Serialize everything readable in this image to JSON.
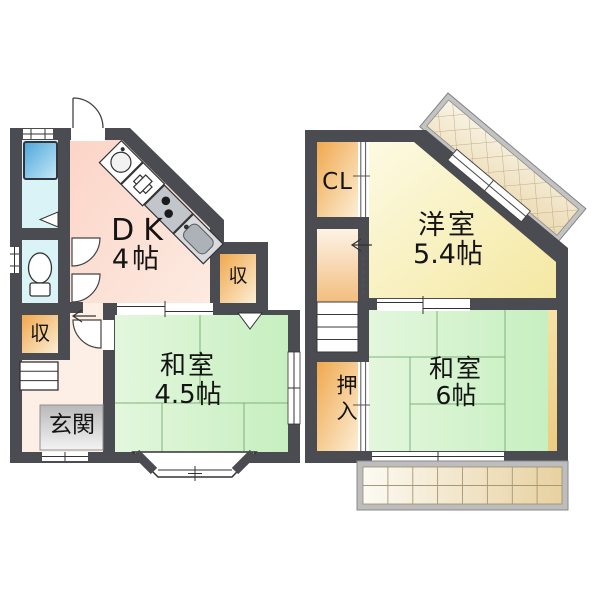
{
  "palette": {
    "wall": "#4b4b52",
    "tatami_green": "#cdefc6",
    "dk_pink": "#fbd8cb",
    "western_yellow": "#fbf4be",
    "closet_orange": "#f0a84e",
    "bath_cyan": "#d9f3f7",
    "tub_blue": "#56aadd",
    "balcony_beige": "#e9d4a5",
    "entry_gray": "#c4c4c4"
  },
  "floor1": {
    "dk": {
      "name": "DK",
      "size": "4帖"
    },
    "washitsu": {
      "name": "和室",
      "size": "4.5帖"
    },
    "genkan": {
      "name": "玄関"
    },
    "storage_upper": {
      "name": "収"
    },
    "storage_lower": {
      "name": "収"
    }
  },
  "floor2": {
    "closet": {
      "name": "CL"
    },
    "yoshitsu": {
      "name": "洋室",
      "size": "5.4帖"
    },
    "washitsu": {
      "name": "和室",
      "size": "6帖"
    },
    "oshiire": {
      "name": "押入"
    }
  }
}
